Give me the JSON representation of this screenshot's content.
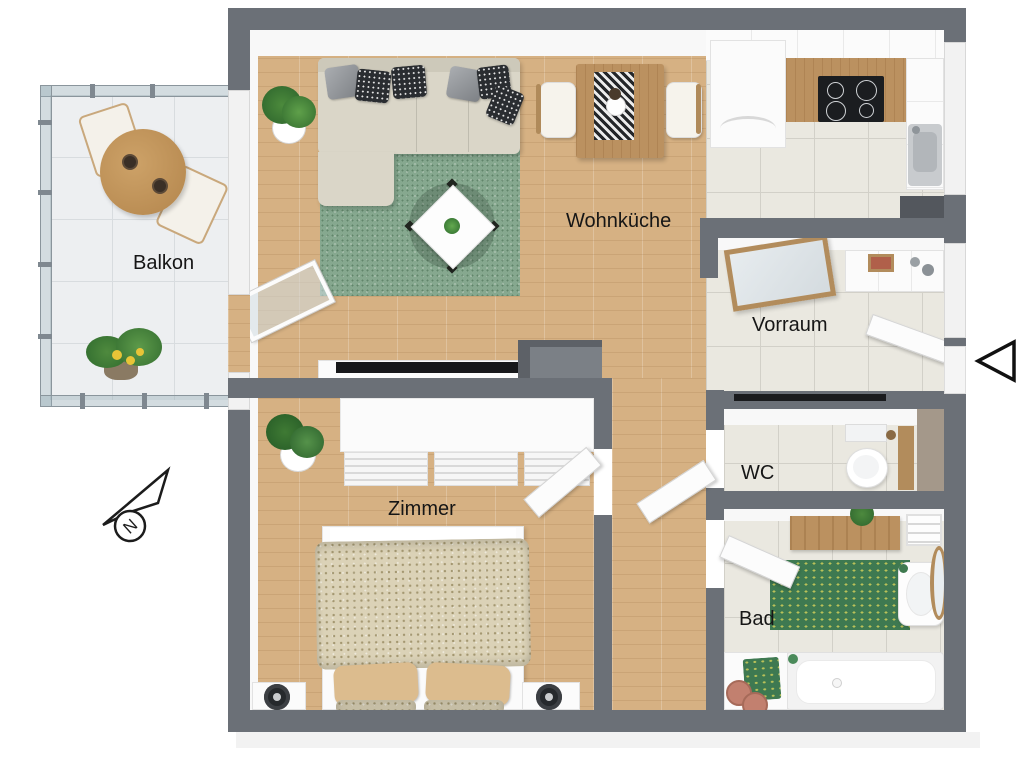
{
  "plan": {
    "type": "3d-floor-plan-top-view"
  },
  "rooms": {
    "balkon": "Balkon",
    "wohnkueche": "Wohnküche",
    "vorraum": "Vorraum",
    "zimmer": "Zimmer",
    "wc": "WC",
    "bad": "Bad"
  },
  "compass": {
    "north_letter": "N"
  },
  "entrance": {
    "icon": "left-pointing-triangle"
  },
  "colors": {
    "wall": "#6b7077",
    "wood_floor": "#d6b183",
    "tile_floor": "#eae8e0",
    "balcony_floor": "#edeff1",
    "rug_green": "#86a88f",
    "bath_rug_green": "#3e7951",
    "sofa_beige": "#dad6c8",
    "counter_wood": "#bb9160",
    "label_text": "#161616"
  }
}
